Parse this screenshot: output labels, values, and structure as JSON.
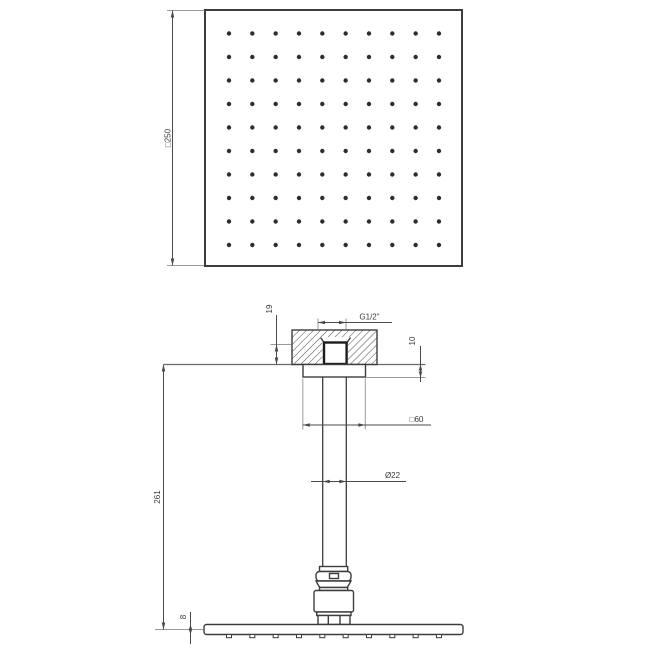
{
  "diagram": {
    "colors": {
      "background": "#ffffff",
      "outline": "#3d3d3d",
      "dimension_line": "#4a4a4a",
      "extension_line": "#9a9a9a",
      "text": "#3a3a3a",
      "hatch": "#4a4a4a"
    },
    "top_view": {
      "labels": {
        "head_size": "□250"
      },
      "nozzle_grid": {
        "rows": 10,
        "cols": 10,
        "x0": 229,
        "y0": 33.5,
        "dx": 23.33,
        "dy": 23.5,
        "r": 2.2
      }
    },
    "front_view": {
      "labels": {
        "thread": "G1/2\"",
        "thread_depth": "19",
        "flange_height": "10",
        "flange_size": "□60",
        "arm_diameter": "Ø22",
        "drop_length": "261",
        "head_thickness": "8"
      },
      "face_nozzles": {
        "count": 10,
        "x0": 229,
        "dx": 23.33,
        "y": 634.5,
        "w": 5,
        "h": 3.2
      }
    }
  }
}
